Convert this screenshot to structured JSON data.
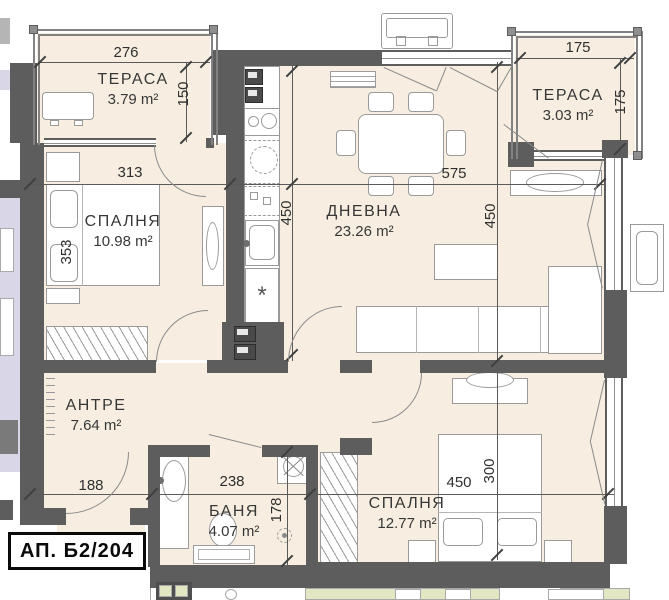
{
  "plan": {
    "apartment_label": "АП. Б2/204",
    "rooms": {
      "terrace1": {
        "name": "ТЕРАСА",
        "area": "3.79 m²"
      },
      "bedroom1": {
        "name": "СПАЛНЯ",
        "area": "10.98 m²"
      },
      "living": {
        "name": "ДНЕВНА",
        "area": "23.26 m²"
      },
      "terrace2": {
        "name": "ТЕРАСА",
        "area": "3.03 m²"
      },
      "hall": {
        "name": "АНТРЕ",
        "area": "7.64 m²"
      },
      "bath": {
        "name": "БАНЯ",
        "area": "4.07 m²"
      },
      "bedroom2": {
        "name": "СПАЛНЯ",
        "area": "12.77 m²"
      }
    },
    "dimensions": {
      "terrace1_width": "276",
      "terrace1_depth": "150",
      "bedroom1_width": "313",
      "bedroom1_depth": "353",
      "living_width": "575",
      "kitchen_depth": "450",
      "living_depth": "450",
      "terrace2_width": "175",
      "terrace2_depth": "175",
      "hall_width": "188",
      "bath_width": "238",
      "bath_depth": "178",
      "bedroom2_width": "450",
      "bedroom2_depth": "300"
    },
    "symbols": {
      "dishwasher_star": "*"
    },
    "colors": {
      "wall": "#5e5d5d",
      "floor": "#f7eee1",
      "neighbor_left": "#d9d6e8",
      "neighbor_bottom": "#e2e6c3",
      "furniture_outline": "#9a9a9a",
      "dim_text": "#2f2f2f"
    }
  }
}
